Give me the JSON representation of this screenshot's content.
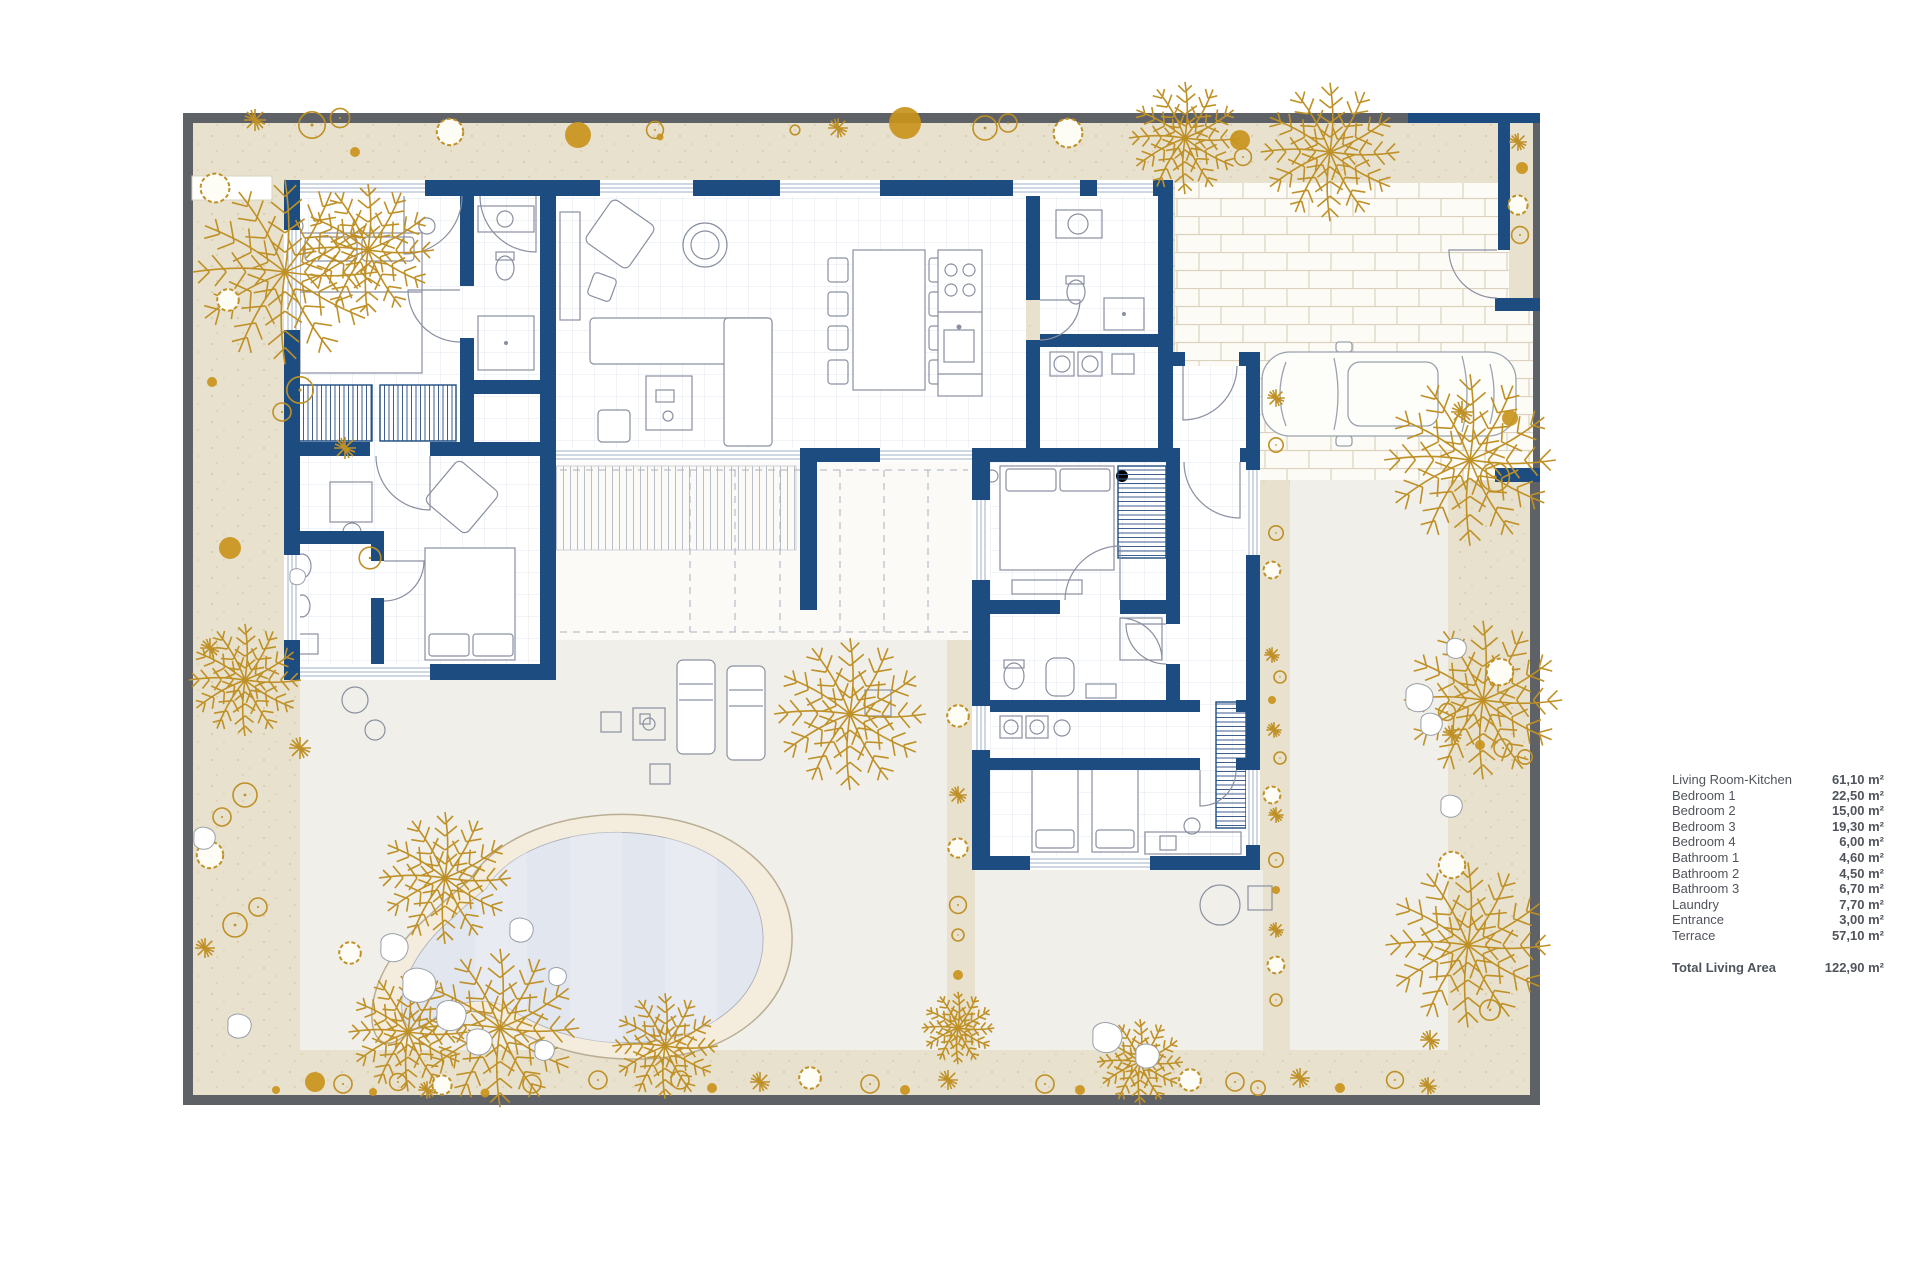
{
  "legend": {
    "rows": [
      {
        "label": "Living Room-Kitchen",
        "value": "61,10 m²"
      },
      {
        "label": "Bedroom 1",
        "value": "22,50 m²"
      },
      {
        "label": "Bedroom 2",
        "value": "15,00 m²"
      },
      {
        "label": "Bedroom 3",
        "value": "19,30 m²"
      },
      {
        "label": "Bedroom 4",
        "value": "6,00 m²"
      },
      {
        "label": "Bathroom 1",
        "value": "4,60 m²"
      },
      {
        "label": "Bathroom 2",
        "value": "4,50 m²"
      },
      {
        "label": "Bathroom 3",
        "value": "6,70 m²"
      },
      {
        "label": "Laundry",
        "value": "7,70 m²"
      },
      {
        "label": "Entrance",
        "value": "3,00 m²"
      },
      {
        "label": "Terrace",
        "value": "57,10 m²"
      }
    ],
    "total": {
      "label": "Total Living Area",
      "value": "122,90 m²"
    }
  },
  "plan": {
    "colors": {
      "wall": "#1d4d80",
      "plot-border": "#5e6165",
      "garden": "#e8e1cd",
      "plant": "#bf9026",
      "plant-dark": "#c8941c",
      "courtyard": "#f0efe9",
      "pool-water": "#e2e6ee",
      "pool-deck": "#f4ecdc",
      "grid": "#e2e7f0",
      "text": "#50555c"
    }
  }
}
